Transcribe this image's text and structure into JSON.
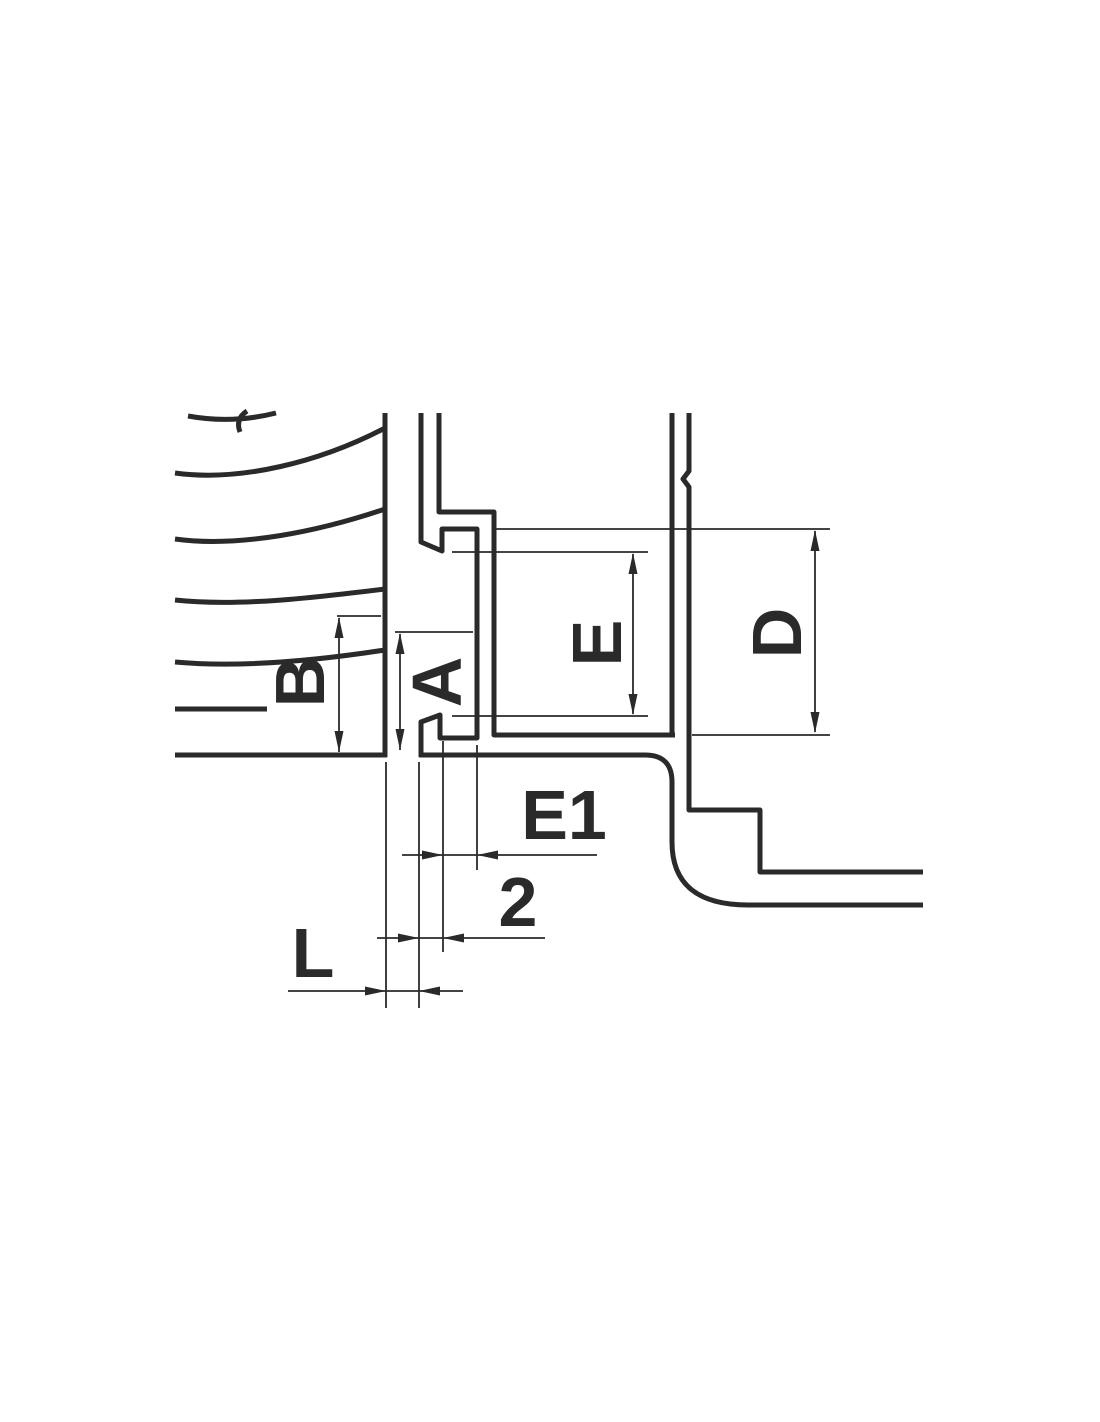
{
  "page": {
    "background": "#ffffff"
  },
  "drawing": {
    "line_color": "#2a2a2a",
    "label_color": "#2a2a2a",
    "thick_width": 5,
    "thin_width": 1.8,
    "parts": {
      "bell_vertical_face": "M 385 413 L 385 757",
      "bell_bottom_face": "M 175 755 L 387 755",
      "bell_top_arc": "M 188 416 Q 232 424 276 413",
      "bell_break_curve": "M 247 411 Q 235 419 240 432",
      "bell_curve_2": "M 175 473 C 240 482 320 462 385 428",
      "bell_curve_3": "M 175 539 C 240 548 320 531 385 509",
      "bell_curve_4": "M 175 600 C 240 607 320 597 385 589",
      "bell_curve_5": "M 175 662 C 240 668 320 660 385 650",
      "bell_inner_line": "M 175 709 L 267 709",
      "spigot_hook_profile": "M 421 413 L 421 542 L 442 551 L 442 529 L 477 529 L 477 738 L 440 738 L 440 715 L 421 722 L 421 757",
      "spigot_flange_profile": "M 439 413 L 439 512 L 494 512 L 494 735 L 675 735",
      "duct_wall_left": "M 672 413 L 672 737",
      "duct_wall_right_step": "M 689 413 L 689 471 L 683 479 L 689 487 L 689 810 L 760 810 L 760 872 L 923 872",
      "duct_outer_bend": "M 419 755 L 645 755 Q 672 755 672 782 L 672 842 Q 672 905 748 905 L 923 905"
    },
    "dims": {
      "b_ext_top": "M 337 616 L 381 616",
      "b_line": "M 339 618 L 339 752",
      "a_ext_top": "M 395 632 L 473 632",
      "a_line": "M 400 634 L 400 750",
      "e_ext_top": "M 452 552 L 648 552",
      "e_ext_bottom": "M 452 716 L 648 716",
      "e_line": "M 633 554 L 633 714",
      "d_ext_top": "M 493 529 L 830 529",
      "d_ext_bottom": "M 692 735 L 830 735",
      "d_line": "M 815 531 L 815 732",
      "e1_ext_left": "M 443 741 L 443 952",
      "e1_ext_right": "M 477 745 L 477 870",
      "e1_line": "M 402 855 L 597 855",
      "two_ext_left": "M 419 762 L 419 1008",
      "two_line": "M 377 938 L 545 938",
      "l_ext_left": "M 386 762 L 386 1008",
      "l_line": "M 288 991 L 463 991"
    },
    "heads": {
      "b_heads": "M 339 617 L 334.5 638 L 343.5 638 Z M 339 752 L 334.5 731 L 343.5 731 Z",
      "a_heads": "M 400 633 L 395.5 654 L 404.5 654 Z M 400 750 L 395.5 729 L 404.5 729 Z",
      "e_heads": "M 633 553 L 628.5 574 L 637.5 574 Z M 633 715 L 628.5 694 L 637.5 694 Z",
      "d_heads": "M 815 530 L 810.5 551 L 819.5 551 Z M 815 733 L 810.5 712 L 819.5 712 Z",
      "e1_heads": "M 443 855 L 422 850.5 L 422 859.5 Z M 477 855 L 498 850.5 L 498 859.5 Z",
      "two_heads": "M 419 938 L 398 933.5 L 398 942.5 Z M 443 938 L 464 933.5 L 464 942.5 Z",
      "l_heads": "M 386 991 L 365 986.5 L 365 995.5 Z M 419 991 L 440 986.5 L 440 995.5 Z"
    },
    "labels": {
      "b": {
        "text": "B",
        "x": 300,
        "y": 682,
        "transform": "rotate(-90 300 682)"
      },
      "a": {
        "text": "A",
        "x": 437,
        "y": 682,
        "transform": "rotate(-90 437 682)"
      },
      "e": {
        "text": "E",
        "x": 597,
        "y": 643,
        "transform": "rotate(-90 597 643)"
      },
      "d": {
        "text": "D",
        "x": 777,
        "y": 633,
        "transform": "rotate(-90 777 633)"
      },
      "e1": {
        "text": "E1",
        "x": 564,
        "y": 815,
        "transform": "rotate(0)"
      },
      "two": {
        "text": "2",
        "x": 518,
        "y": 902,
        "transform": "rotate(0)"
      },
      "l": {
        "text": "L",
        "x": 313,
        "y": 953,
        "transform": "rotate(0)"
      }
    }
  }
}
